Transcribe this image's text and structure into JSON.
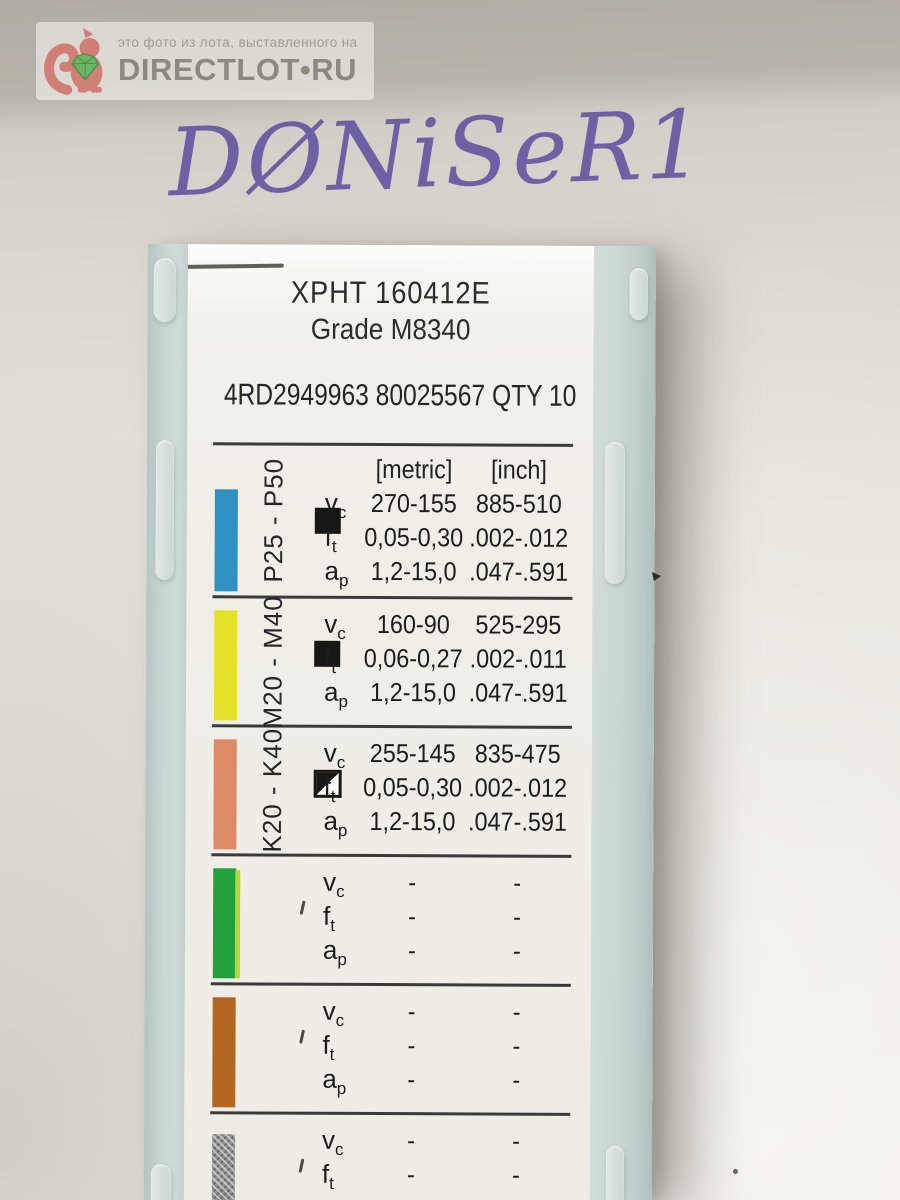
{
  "watermark": {
    "caption": "это фото из лота, выставленного на",
    "site": "DIRECTLOT•RU",
    "logo_icon": "squirrel-with-gem-icon",
    "logo_red": "#cf6a60",
    "gem_green": "#4fae46",
    "text_grey": "#8e897e"
  },
  "handwriting": {
    "text": "DØNiSeR1",
    "ink_color": "#5a4d9c"
  },
  "box": {
    "plastic_color": "#c6d4d1"
  },
  "label": {
    "designation": "XPHT 160412E",
    "grade": "Grade M8340",
    "code_line": "4RD2949963 80025567 QTY 10",
    "units": {
      "metric": "[metric]",
      "inch": "[inch]"
    },
    "params": {
      "v": "v",
      "v_sub": "c",
      "f": "f",
      "f_sub": "t",
      "a": "a",
      "a_sub": "p"
    },
    "rows": [
      {
        "range": "P25 - P50",
        "icon": "filled-square",
        "bar_color": "#2e91c1",
        "vc_metric": "270-155",
        "vc_inch": "885-510",
        "f_metric": "0,05-0,30",
        "f_inch": ".002-.012",
        "ap_metric": "1,2-15,0",
        "ap_inch": ".047-.591"
      },
      {
        "range": "M20 - M40",
        "icon": "filled-square",
        "bar_color": "#e5e128",
        "vc_metric": "160-90",
        "vc_inch": "525-295",
        "f_metric": "0,06-0,27",
        "f_inch": ".002-.011",
        "ap_metric": "1,2-15,0",
        "ap_inch": ".047-.591"
      },
      {
        "range": "K20 - K40",
        "icon": "half-filled-square",
        "bar_color": "#dd8a66",
        "vc_metric": "255-145",
        "vc_inch": "835-475",
        "f_metric": "0,05-0,30",
        "f_inch": ".002-.012",
        "ap_metric": "1,2-15,0",
        "ap_inch": ".047-.591"
      },
      {
        "range": "",
        "icon": "none",
        "bar_color": "#22a03c",
        "vc_metric": "-",
        "vc_inch": "-",
        "f_metric": "-",
        "f_inch": "-",
        "ap_metric": "-",
        "ap_inch": "-"
      },
      {
        "range": "",
        "icon": "none",
        "bar_color": "#b2661f",
        "vc_metric": "-",
        "vc_inch": "-",
        "f_metric": "-",
        "f_inch": "-",
        "ap_metric": "-",
        "ap_inch": "-"
      },
      {
        "range": "",
        "icon": "none",
        "bar_color": "#8f8f8f",
        "vc_metric": "-",
        "vc_inch": "-",
        "f_metric": "-",
        "f_inch": "-",
        "ap_metric": "-",
        "ap_inch": "-"
      }
    ]
  }
}
